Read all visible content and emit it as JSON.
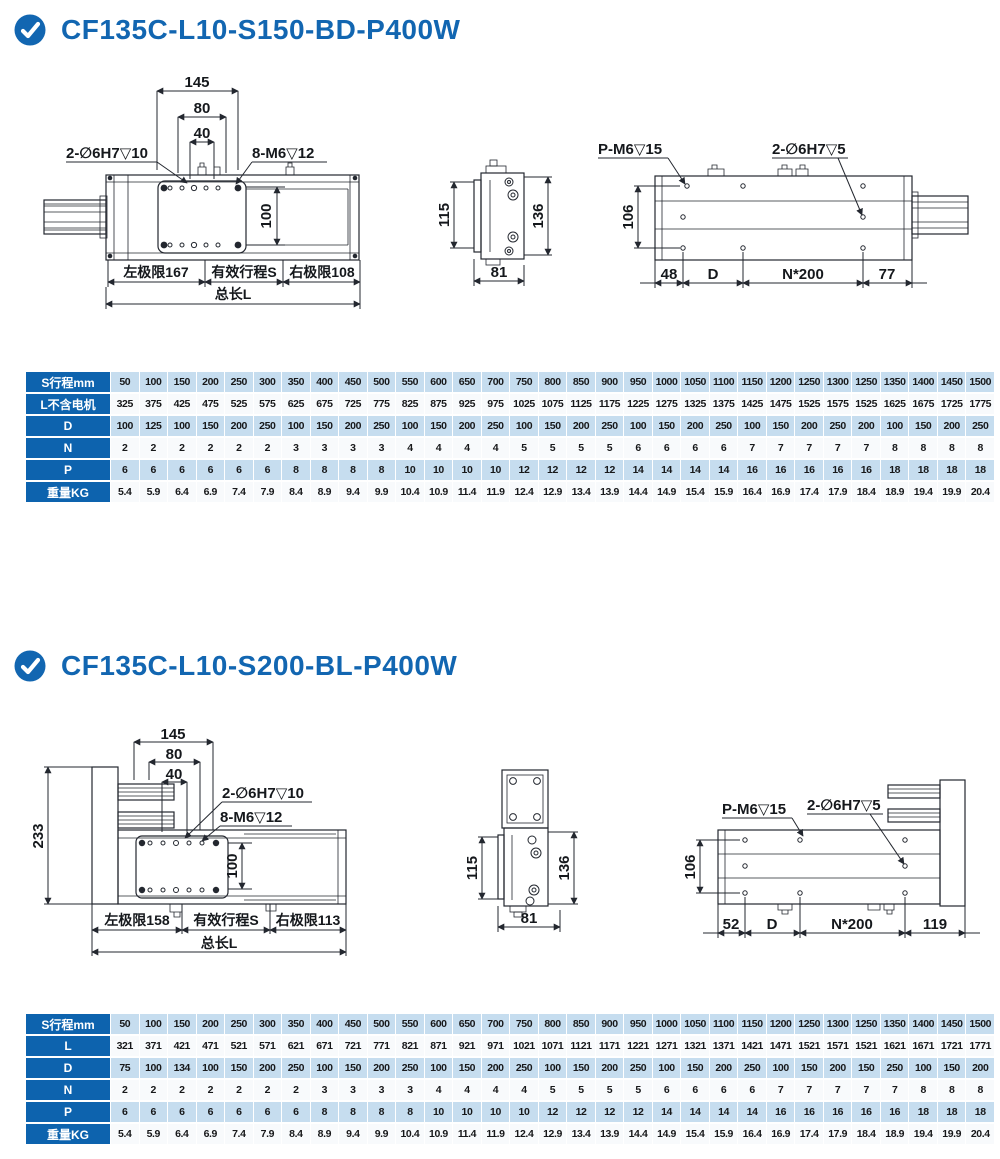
{
  "colors": {
    "accent": "#1266b1",
    "table_header": "#0d63ae",
    "row_blue": "#c6ddef",
    "row_white": "#f8fafc",
    "line": "#23272f"
  },
  "sections": [
    {
      "title": "CF135C-L10-S150-BD-P400W",
      "views": {
        "top": {
          "dim145": "145",
          "dim80": "80",
          "dim40": "40",
          "hole_label": "2-∅6H7▽10",
          "screw_label": "8-M6▽12",
          "dim100": "100",
          "left_limit": "左极限167",
          "stroke_label": "有效行程S",
          "right_limit": "右极限108",
          "total_label": "总长L"
        },
        "end": {
          "dim115": "115",
          "dim136": "136",
          "dim81": "81"
        },
        "bottom": {
          "pm6_label": "P-M6▽15",
          "hole_label": "2-∅6H7▽5",
          "dim106": "106",
          "dim_a": "48",
          "dim_d": "D",
          "dim_n": "N*200",
          "dim_b": "77"
        }
      },
      "table": {
        "rows": [
          {
            "header": "S行程mm",
            "values": [
              "50",
              "100",
              "150",
              "200",
              "250",
              "300",
              "350",
              "400",
              "450",
              "500",
              "550",
              "600",
              "650",
              "700",
              "750",
              "800",
              "850",
              "900",
              "950",
              "1000",
              "1050",
              "1100",
              "1150",
              "1200",
              "1250",
              "1300",
              "1250",
              "1350",
              "1400",
              "1450",
              "1500"
            ]
          },
          {
            "header": "L不含电机",
            "values": [
              "325",
              "375",
              "425",
              "475",
              "525",
              "575",
              "625",
              "675",
              "725",
              "775",
              "825",
              "875",
              "925",
              "975",
              "1025",
              "1075",
              "1125",
              "1175",
              "1225",
              "1275",
              "1325",
              "1375",
              "1425",
              "1475",
              "1525",
              "1575",
              "1525",
              "1625",
              "1675",
              "1725",
              "1775"
            ]
          },
          {
            "header": "D",
            "values": [
              "100",
              "125",
              "100",
              "150",
              "200",
              "250",
              "100",
              "150",
              "200",
              "250",
              "100",
              "150",
              "200",
              "250",
              "100",
              "150",
              "200",
              "250",
              "100",
              "150",
              "200",
              "250",
              "100",
              "150",
              "200",
              "250",
              "200",
              "100",
              "150",
              "200",
              "250"
            ]
          },
          {
            "header": "N",
            "values": [
              "2",
              "2",
              "2",
              "2",
              "2",
              "2",
              "3",
              "3",
              "3",
              "3",
              "4",
              "4",
              "4",
              "4",
              "5",
              "5",
              "5",
              "5",
              "6",
              "6",
              "6",
              "6",
              "7",
              "7",
              "7",
              "7",
              "7",
              "8",
              "8",
              "8",
              "8"
            ]
          },
          {
            "header": "P",
            "values": [
              "6",
              "6",
              "6",
              "6",
              "6",
              "6",
              "8",
              "8",
              "8",
              "8",
              "10",
              "10",
              "10",
              "10",
              "12",
              "12",
              "12",
              "12",
              "14",
              "14",
              "14",
              "14",
              "16",
              "16",
              "16",
              "16",
              "16",
              "18",
              "18",
              "18",
              "18"
            ]
          },
          {
            "header": "重量KG",
            "values": [
              "5.4",
              "5.9",
              "6.4",
              "6.9",
              "7.4",
              "7.9",
              "8.4",
              "8.9",
              "9.4",
              "9.9",
              "10.4",
              "10.9",
              "11.4",
              "11.9",
              "12.4",
              "12.9",
              "13.4",
              "13.9",
              "14.4",
              "14.9",
              "15.4",
              "15.9",
              "16.4",
              "16.9",
              "17.4",
              "17.9",
              "18.4",
              "18.9",
              "19.4",
              "19.9",
              "20.4"
            ]
          }
        ]
      }
    },
    {
      "title": "CF135C-L10-S200-BL-P400W",
      "views": {
        "top": {
          "dim233": "233",
          "dim145": "145",
          "dim80": "80",
          "dim40": "40",
          "hole_label": "2-∅6H7▽10",
          "screw_label": "8-M6▽12",
          "dim100": "100",
          "left_limit": "左极限158",
          "stroke_label": "有效行程S",
          "right_limit": "右极限113",
          "total_label": "总长L"
        },
        "end": {
          "dim115": "115",
          "dim136": "136",
          "dim81": "81"
        },
        "bottom": {
          "pm6_label": "P-M6▽15",
          "hole_label": "2-∅6H7▽5",
          "dim106": "106",
          "dim_a": "52",
          "dim_d": "D",
          "dim_n": "N*200",
          "dim_b": "119"
        }
      },
      "table": {
        "rows": [
          {
            "header": "S行程mm",
            "values": [
              "50",
              "100",
              "150",
              "200",
              "250",
              "300",
              "350",
              "400",
              "450",
              "500",
              "550",
              "600",
              "650",
              "700",
              "750",
              "800",
              "850",
              "900",
              "950",
              "1000",
              "1050",
              "1100",
              "1150",
              "1200",
              "1250",
              "1300",
              "1250",
              "1350",
              "1400",
              "1450",
              "1500"
            ]
          },
          {
            "header": "L",
            "values": [
              "321",
              "371",
              "421",
              "471",
              "521",
              "571",
              "621",
              "671",
              "721",
              "771",
              "821",
              "871",
              "921",
              "971",
              "1021",
              "1071",
              "1121",
              "1171",
              "1221",
              "1271",
              "1321",
              "1371",
              "1421",
              "1471",
              "1521",
              "1571",
              "1521",
              "1621",
              "1671",
              "1721",
              "1771"
            ]
          },
          {
            "header": "D",
            "values": [
              "75",
              "100",
              "134",
              "100",
              "150",
              "200",
              "250",
              "100",
              "150",
              "200",
              "250",
              "100",
              "150",
              "200",
              "250",
              "100",
              "150",
              "200",
              "250",
              "100",
              "150",
              "200",
              "250",
              "100",
              "150",
              "200",
              "150",
              "250",
              "100",
              "150",
              "200"
            ]
          },
          {
            "header": "N",
            "values": [
              "2",
              "2",
              "2",
              "2",
              "2",
              "2",
              "2",
              "3",
              "3",
              "3",
              "3",
              "4",
              "4",
              "4",
              "4",
              "5",
              "5",
              "5",
              "5",
              "6",
              "6",
              "6",
              "6",
              "7",
              "7",
              "7",
              "7",
              "7",
              "8",
              "8",
              "8"
            ]
          },
          {
            "header": "P",
            "values": [
              "6",
              "6",
              "6",
              "6",
              "6",
              "6",
              "6",
              "8",
              "8",
              "8",
              "8",
              "10",
              "10",
              "10",
              "10",
              "12",
              "12",
              "12",
              "12",
              "14",
              "14",
              "14",
              "14",
              "16",
              "16",
              "16",
              "16",
              "16",
              "18",
              "18",
              "18"
            ]
          },
          {
            "header": "重量KG",
            "values": [
              "5.4",
              "5.9",
              "6.4",
              "6.9",
              "7.4",
              "7.9",
              "8.4",
              "8.9",
              "9.4",
              "9.9",
              "10.4",
              "10.9",
              "11.4",
              "11.9",
              "12.4",
              "12.9",
              "13.4",
              "13.9",
              "14.4",
              "14.9",
              "15.4",
              "15.9",
              "16.4",
              "16.9",
              "17.4",
              "17.9",
              "18.4",
              "18.9",
              "19.4",
              "19.9",
              "20.4"
            ]
          }
        ]
      }
    }
  ]
}
